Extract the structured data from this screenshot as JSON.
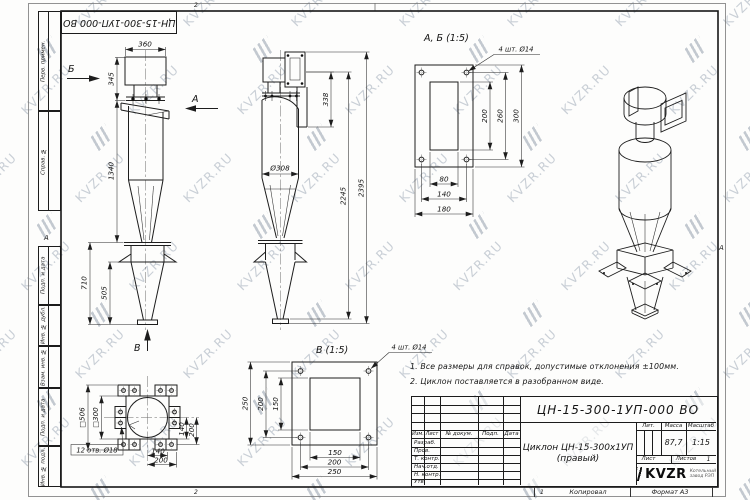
{
  "watermark": {
    "text": "KVZR.RU"
  },
  "sheet": {
    "top_stamp": "ЦН-15-300-1УП-000 ВО",
    "fold_top": "2",
    "fold_bottom": "2",
    "zone_left": "А",
    "zone_right": "А",
    "copy_num": "1",
    "copied_label": "Копировал",
    "format_label": "Формат А3"
  },
  "margin_labels": [
    "Перв. примен.",
    "Справ. №",
    "Подп. и дата",
    "Инв. № дубл.",
    "Взам. инв. №",
    "Подп. и дата",
    "Инв. № подл."
  ],
  "views": {
    "front": {
      "dir_b": "Б",
      "dir_a": "А",
      "dir_v": "В",
      "dim_360": "360",
      "dim_345": "345",
      "dim_1340": "1340",
      "dim_710": "710",
      "dim_505": "505"
    },
    "side": {
      "dim_338": "338",
      "dim_dia": "Ø308",
      "dim_2245": "2245",
      "dim_2395": "2395"
    },
    "detail_ab": {
      "title": "А, Б (1:5)",
      "holes": "4 шт. Ø14",
      "dim_200": "200",
      "dim_260": "260",
      "dim_300": "300",
      "dim_80": "80",
      "dim_140": "140",
      "dim_180": "180"
    },
    "detail_v": {
      "title": "В (1:5)",
      "holes": "4 шт. Ø14",
      "dim_150v": "150",
      "dim_200v": "200",
      "dim_250v": "250",
      "dim_150h": "150",
      "dim_200h": "200",
      "dim_250h": "250"
    },
    "bottom": {
      "dim_outer": "□506",
      "dim_inner": "□300",
      "dim_140v": "140",
      "dim_200v": "200",
      "dim_140h": "140",
      "dim_200h": "200",
      "holes": "12 отв. Ø18"
    }
  },
  "notes": {
    "lines": [
      "1. Все размеры для справок, допустимые отклонения ±100мм.",
      "2. Циклон поставляется в разобранном виде."
    ]
  },
  "title_block": {
    "doc_number": "ЦН-15-300-1УП-000 ВО",
    "name_line1": "Циклон ЦН-15-300х1УП",
    "name_line2": "(правый)",
    "cols": [
      "Изм.",
      "Лист",
      "№ докум.",
      "Подп.",
      "Дата"
    ],
    "sig_rows": [
      "Разраб.",
      "Пров.",
      "Т. контр.",
      "Нач.отд.",
      "Н. контр.",
      "Утв."
    ],
    "lit_label": "Лит.",
    "mass_label": "Масса",
    "scale_label": "Масштаб",
    "mass_value": "87,7",
    "scale_value": "1:15",
    "sheet_label": "Лист",
    "sheets_label": "Листов",
    "sheets_value": "1",
    "logo_text": "KVZR",
    "logo_sub1": "Котельный",
    "logo_sub2": "завод РЭП"
  }
}
